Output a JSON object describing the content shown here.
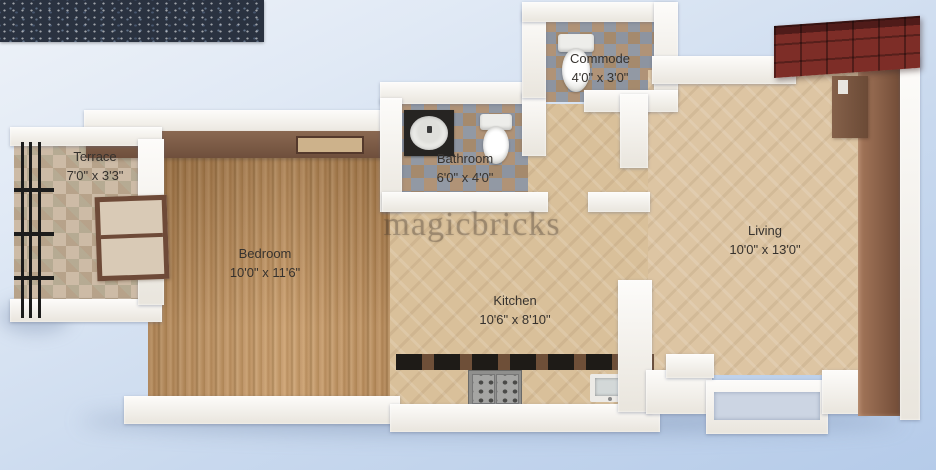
{
  "watermark": "magicbricks",
  "rooms": [
    {
      "name": "Terrace",
      "dims": "7'0\" x 3'3\""
    },
    {
      "name": "Bedroom",
      "dims": "10'0\" x 11'6\""
    },
    {
      "name": "Bathroom",
      "dims": "6'0\" x 4'0\""
    },
    {
      "name": "Commode",
      "dims": "4'0\" x 3'0\""
    },
    {
      "name": "Kitchen",
      "dims": "10'6\" x 8'10\""
    },
    {
      "name": "Living",
      "dims": "10'0\" x 13'0\""
    }
  ],
  "colors": {
    "background_top": "#eef2f8",
    "background_bottom": "#b5cbe9",
    "wall": "#f6f4ef",
    "wood_floor": "#b68a58",
    "tile_floor": "#d9c09a",
    "terrace_tile": "#cdbba6",
    "checker_gray": "#9299a4",
    "checker_brown": "#a58a6d",
    "counter_granite": "#2a3240",
    "main_door_maroon": "#6b2320",
    "wood_wall": "#8a6851",
    "railing": "#1c1c1c",
    "label_text": "#36322e"
  }
}
